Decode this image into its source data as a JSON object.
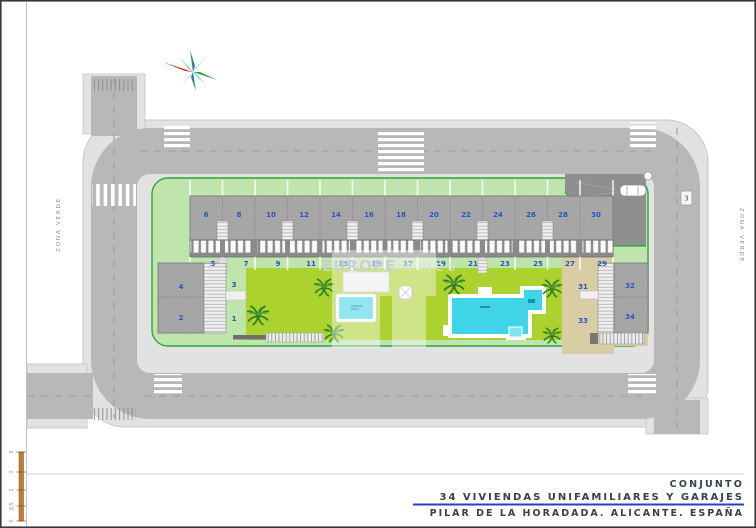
{
  "title_block": {
    "line1": "CONJUNTO",
    "line2": "34 VIVIENDAS UNIFAMILIARES Y GARAJES",
    "line3": "PILAR DE LA HORADADA. ALICANTE. ESPAÑA"
  },
  "watermark": {
    "primary": "EUROPE",
    "secondary": "homes"
  },
  "labels": {
    "zona_verde_west": "ZONA VERDE",
    "zona_verde_east": "ZONA VERDE",
    "street_marker": "3"
  },
  "units": {
    "top_row": [
      "6",
      "8",
      "10",
      "12",
      "14",
      "16",
      "18",
      "20",
      "22",
      "24",
      "26",
      "28",
      "30"
    ],
    "bottom_row": [
      "5",
      "7",
      "9",
      "11",
      "13",
      "15",
      "17",
      "19",
      "21",
      "23",
      "25",
      "27",
      "29"
    ],
    "west_block": {
      "n4": "4",
      "n2": "2",
      "n3": "3",
      "n1": "1"
    },
    "east_block": {
      "n32": "32",
      "n34": "34",
      "n31": "31",
      "n33": "33"
    }
  },
  "scale_bar": {
    "ticks": [
      "0",
      "0.5",
      "1",
      "2",
      "5"
    ]
  },
  "icons": {
    "compass": "compass-rose-icon",
    "car": "car-top-view-icon",
    "palm": "palm-tree-icon"
  },
  "colors": {
    "road": "#b8b8b8",
    "sidewalk": "#e2e2e2",
    "green_band": "#bfe5ad",
    "courtyard": "#abd22f",
    "roof": "#a7a7a7",
    "pool": "#3fd4e8",
    "sand": "#d8cda4",
    "unit_number_blue": "#2753c5",
    "underline_blue": "#2b3cc8",
    "plot_border": "#2fa23c",
    "compass_red": "#d6281e",
    "scale_orange": "#bf7b33"
  }
}
